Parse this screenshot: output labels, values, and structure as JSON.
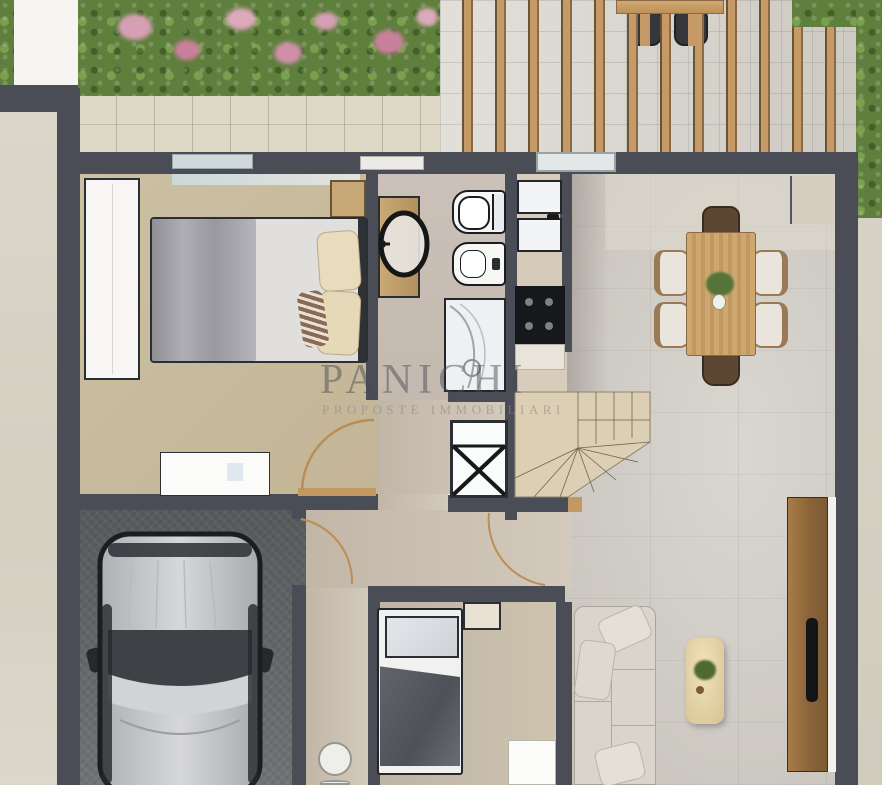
{
  "watermark": {
    "title": "PANICHI",
    "subtitle": "PROPOSTE IMMOBILIARI"
  },
  "plan": {
    "type": "residential-floor-plan-render",
    "view": "top-down ground floor",
    "rooms": [
      {
        "name": "garden",
        "items": [
          "hedge",
          "pink-flower-shrubs"
        ]
      },
      {
        "name": "patio",
        "items": [
          "pergola-slats",
          "outdoor-dining-table",
          "outdoor-chairs"
        ]
      },
      {
        "name": "bedroom",
        "items": [
          "double-bed",
          "gray-blanket",
          "cream-pillows",
          "wardrobe",
          "nightstand",
          "dresser"
        ]
      },
      {
        "name": "bathroom",
        "items": [
          "vanity-with-oval-mirror",
          "toilet",
          "bidet",
          "shower"
        ]
      },
      {
        "name": "kitchen",
        "items": [
          "double-sink",
          "cooktop",
          "counters"
        ]
      },
      {
        "name": "dining-area",
        "items": [
          "wooden-table",
          "six-chairs",
          "vase-with-plant",
          "sideboard"
        ]
      },
      {
        "name": "living-room",
        "items": [
          "sofa",
          "cushions",
          "coffee-table",
          "plant"
        ]
      },
      {
        "name": "hallway",
        "items": [
          "washing-machine",
          "door-swing-arcs"
        ]
      },
      {
        "name": "stairs",
        "items": [
          "winder-staircase"
        ]
      },
      {
        "name": "garage",
        "items": [
          "car-top-view"
        ]
      },
      {
        "name": "small-bedroom",
        "items": [
          "single-bed",
          "headboard-shelf",
          "stools"
        ]
      },
      {
        "name": "entry",
        "items": [
          "wooden-entry-door",
          "black-handle"
        ]
      }
    ]
  },
  "colors": {
    "wall": "#4a4d55",
    "living_floor": "#cfcbc3",
    "bedroom_floor": "#c9bd9f",
    "bathroom_floor": "#c8bdb4",
    "hall_floor": "#cfc6b6",
    "garage_floor": "#6a6c70",
    "hedge_green": "#5f7f3d",
    "flower_pink": "#d6a0b4",
    "patio_tile": "#d9d5cd",
    "pergola_wood": "#c59a66",
    "table_wood": "#c9a36a",
    "stairs": "#dccfb3",
    "sofa": "#d9d5cb",
    "car_body": "#c6c7c9",
    "entry_door_wood": "#9a7748",
    "watermark_text": "#55555c"
  }
}
